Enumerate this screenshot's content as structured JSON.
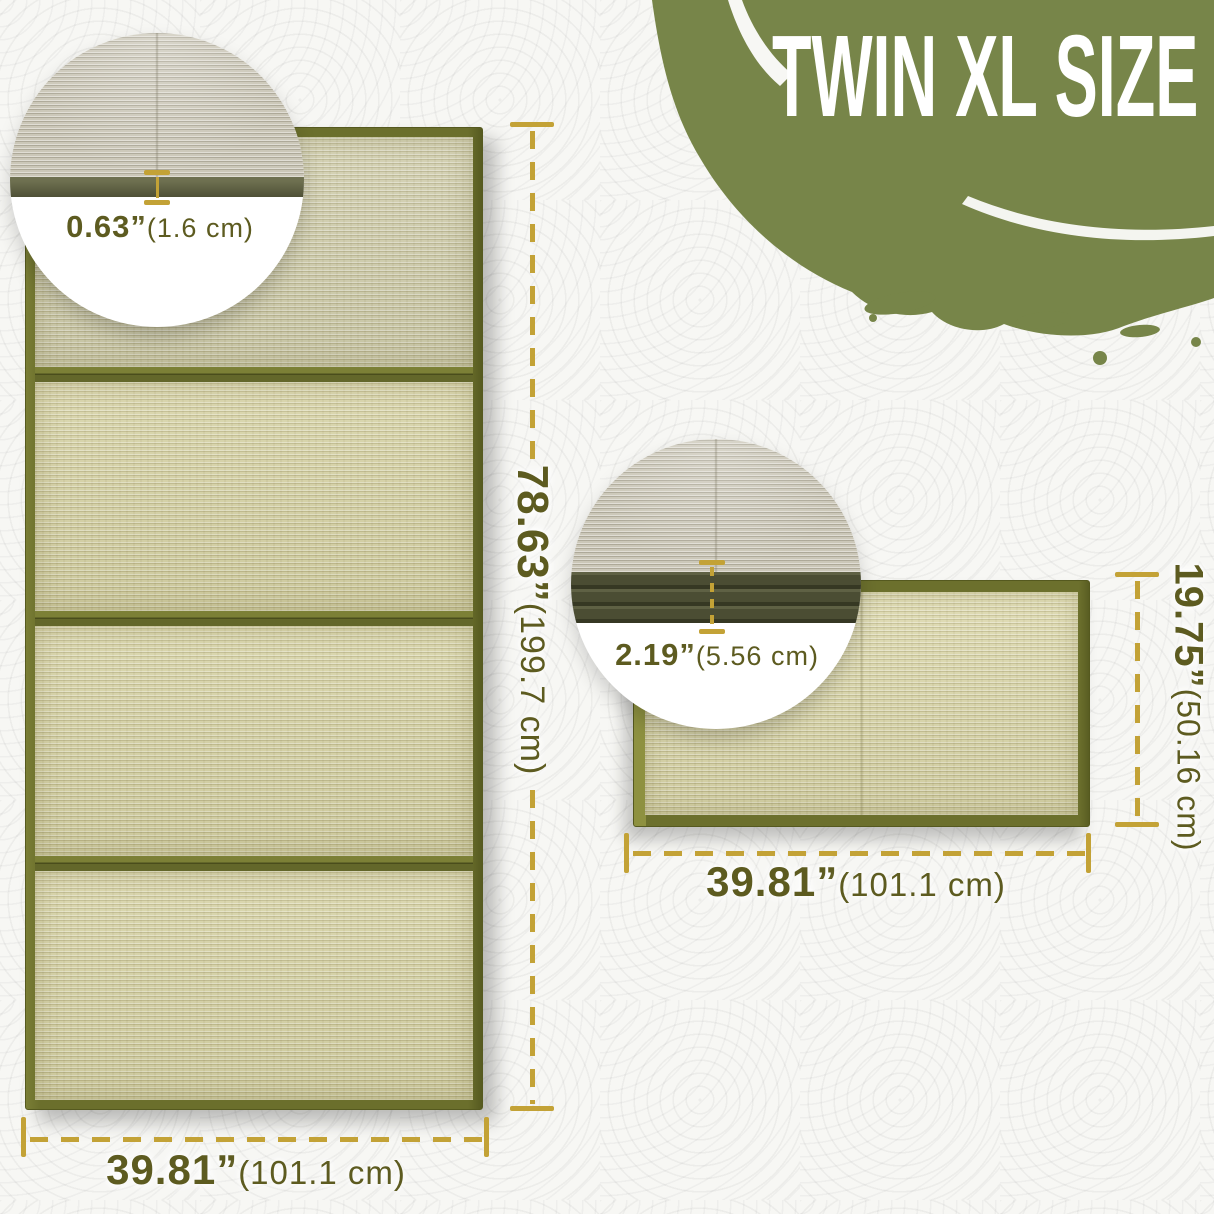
{
  "title": "TWIN XL SIZE",
  "unfolded": {
    "length_in": "78.63”",
    "length_cm": "(199.7 cm)",
    "width_in": "39.81”",
    "width_cm": "(101.1 cm)",
    "thickness_in": "0.63”",
    "thickness_cm": "(1.6 cm)"
  },
  "folded": {
    "height_in": "19.75”",
    "height_cm": "(50.16 cm)",
    "width_in": "39.81”",
    "width_cm": "(101.1 cm)",
    "thickness_in": "2.19”",
    "thickness_cm": "(5.56 cm)"
  },
  "colors": {
    "brush_green": "#778549",
    "accent_gold": "#c3a236",
    "dimension_text_olive": "#5d5b20",
    "mat_border_olive": "#6c702d",
    "mat_surface": "#d6d2a5"
  }
}
